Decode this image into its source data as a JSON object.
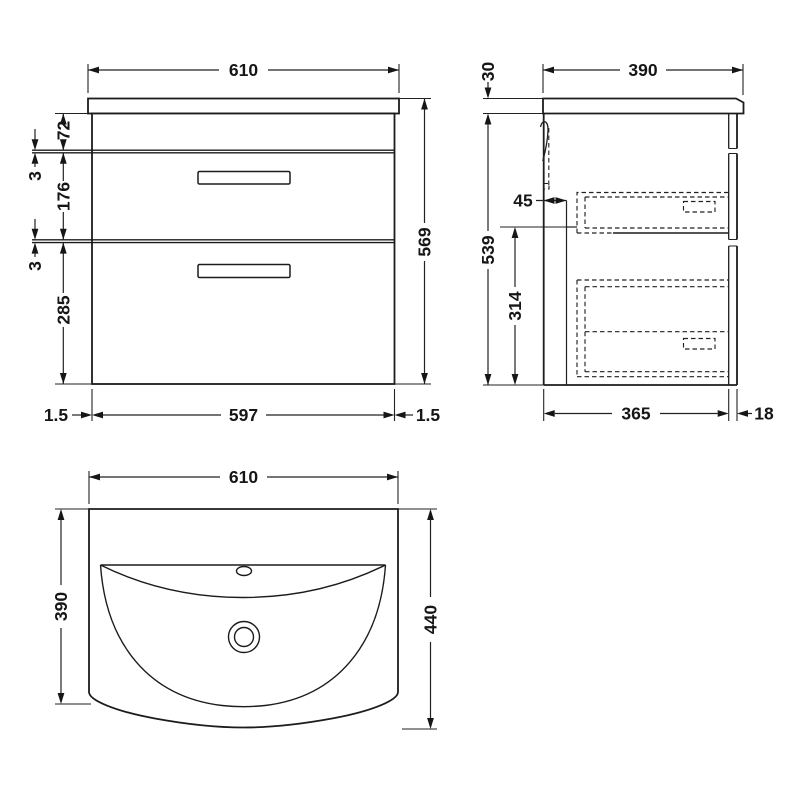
{
  "front_view": {
    "width": "610",
    "height": "569",
    "top_rail": "72",
    "gap_upper": "3",
    "drawer_one": "176",
    "gap_lower": "3",
    "drawer_two": "285",
    "edge_left": "1.5",
    "carcass_width": "597",
    "edge_right": "1.5"
  },
  "side_view": {
    "worktop": "30",
    "depth": "390",
    "height": "539",
    "back_gap": "45",
    "clearance": "314",
    "carcass_depth": "365",
    "front_panel": "18"
  },
  "top_view": {
    "width": "610",
    "basin_depth": "390",
    "overall_depth": "440"
  }
}
